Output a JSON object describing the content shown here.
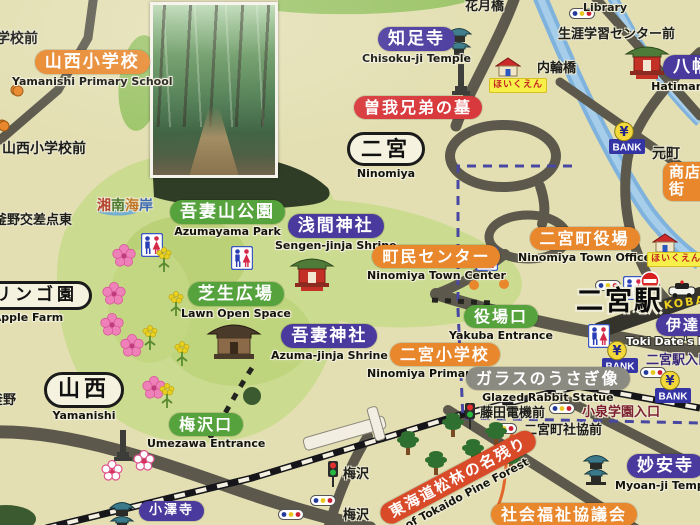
{
  "map": {
    "width": 700,
    "height": 525,
    "kind": "town guide map sign"
  },
  "palette": {
    "background": "#e3dfb2",
    "park_green": "#cbdb90",
    "forest_dark": "#2f3d27",
    "road": "#5c594c",
    "road_dark": "#34332c",
    "river": "#7fb2dc",
    "rail": "#15151a",
    "boundary": "#4848a2",
    "pill_purple": "#4a3a9e",
    "pill_orange": "#e8872c",
    "pill_green": "#56a33d",
    "pill_red": "#d8393c",
    "pill_gray": "#8b8b82",
    "pill_red_diagonal": "#d84a28",
    "bank_blue": "#3434a5",
    "yen_yellow": "#f2d838",
    "hoikuen_yellow": "#f7ef4a",
    "hoikuen_red": "#c42222",
    "koban_yellow": "#f0d020",
    "colorful_chars": [
      "#b5432e",
      "#4a7a2e",
      "#c07828",
      "#3a6ab0"
    ]
  },
  "photo": {
    "name": "forest-path-photo",
    "description": "wooded park trail photo inset"
  },
  "labels": [
    {
      "name": "gakko-mae",
      "type": "plain",
      "jp": "学校前",
      "x": -4,
      "y": 28,
      "fs": 14
    },
    {
      "name": "yamanishi-primary-school",
      "type": "orange-pill",
      "jp": "山西小学校",
      "en": "Yamanishi Primary School",
      "x": 12,
      "y": 50,
      "fs": 17
    },
    {
      "name": "yamanishi-primary-school-mae",
      "type": "plain",
      "jp": "山西小学校前",
      "x": 2,
      "y": 138,
      "fs": 14
    },
    {
      "name": "chisoku-ji-temple",
      "type": "purple-pill",
      "jp": "知足寺",
      "en": "Chisoku-ji Temple",
      "x": 362,
      "y": 27,
      "fs": 17
    },
    {
      "name": "soga-brothers-grave",
      "type": "red-pill",
      "jp": "曽我兄弟の墓",
      "x": 354,
      "y": 96,
      "fs": 16
    },
    {
      "name": "ninomiya-district",
      "type": "white-box",
      "jp": "二宮",
      "en": "Ninomiya",
      "x": 347,
      "y": 132,
      "fs": 21
    },
    {
      "name": "kagetsu-bridge",
      "type": "plain",
      "jp": "花月橋",
      "x": 465,
      "y": -5,
      "fs": 13
    },
    {
      "name": "hoikuen-1",
      "type": "haiku",
      "jp": "ほいくえん",
      "x": 489,
      "y": 78,
      "fs": 9
    },
    {
      "name": "uchiwa-bridge",
      "type": "plain",
      "jp": "内輪橋",
      "x": 537,
      "y": 57,
      "fs": 13
    },
    {
      "name": "library",
      "type": "plain-en",
      "jp": "Library",
      "x": 583,
      "y": 1,
      "fs": 11
    },
    {
      "name": "lifelong-learning-center-mae",
      "type": "plain",
      "jp": "生涯学習センター前",
      "x": 558,
      "y": 23,
      "fs": 13
    },
    {
      "name": "hachimangu",
      "type": "purple-pill",
      "jp": "八幡宮",
      "en": "Hatiman-gu",
      "x": 663,
      "y": 55,
      "fs": 17,
      "en_dx": -14
    },
    {
      "name": "motomachi",
      "type": "plain-outline",
      "jp": "元町",
      "x": 652,
      "y": 143,
      "fs": 14
    },
    {
      "name": "shotengai",
      "type": "orange-pill",
      "jp": "商店街",
      "x": 663,
      "y": 162,
      "fs": 15,
      "w": 36
    },
    {
      "name": "shonan-coast-view",
      "type": "colorful",
      "jp": "湘南海岸",
      "x": 97,
      "y": 195,
      "fs": 14
    },
    {
      "name": "azumayama-park",
      "type": "green-pill",
      "jp": "吾妻山公園",
      "en": "Azumayama Park",
      "x": 170,
      "y": 200,
      "fs": 17
    },
    {
      "name": "sengen-jinja-shrine",
      "type": "purple-pill",
      "jp": "浅間神社",
      "en": "Sengen-jinja Shrine",
      "x": 275,
      "y": 214,
      "fs": 17
    },
    {
      "name": "ninomiya-town-center",
      "type": "orange-pill",
      "jp": "町民センター",
      "en": "Ninomiya Town Center",
      "x": 367,
      "y": 245,
      "fs": 16
    },
    {
      "name": "ninomiya-town-office",
      "type": "orange-pill",
      "jp": "二宮町役場",
      "en": "Ninomiya Town Office",
      "x": 518,
      "y": 227,
      "fs": 16
    },
    {
      "name": "lawn-open-space",
      "type": "green-pill",
      "jp": "芝生広場",
      "en": "Lawn Open Space",
      "x": 181,
      "y": 282,
      "fs": 17
    },
    {
      "name": "apple-farm",
      "type": "white-box",
      "jp": "リンゴ園",
      "en": "Apple Farm",
      "x": -20,
      "y": 281,
      "fs": 17,
      "en_dx": -8
    },
    {
      "name": "yakuba-entrance",
      "type": "green-pill",
      "jp": "役場口",
      "en": "Yakuba Entrance",
      "x": 449,
      "y": 305,
      "fs": 16
    },
    {
      "name": "azuma-jinja-shrine",
      "type": "purple-pill",
      "jp": "吾妻神社",
      "en": "Azuma-jinja Shrine",
      "x": 271,
      "y": 324,
      "fs": 17
    },
    {
      "name": "ninomiya-primary-school",
      "type": "orange-pill",
      "jp": "二宮小学校",
      "en": "Ninomiya Primary School",
      "x": 367,
      "y": 343,
      "fs": 16
    },
    {
      "name": "ninomiya-station",
      "type": "station",
      "jp": "二宮駅",
      "x": 576,
      "y": 288,
      "fs": 27
    },
    {
      "name": "koban",
      "type": "koban",
      "jp": "KOBAN",
      "x": 664,
      "y": 299,
      "fs": 11,
      "rot": -8
    },
    {
      "name": "date-tokei",
      "type": "purple-pill",
      "jp": "伊達時計",
      "x": 656,
      "y": 314,
      "fs": 15
    },
    {
      "name": "toki-date-en",
      "type": "white-outline-text",
      "jp": "Toki Date's Mo",
      "x": 626,
      "y": 335,
      "fs": 11
    },
    {
      "name": "ninomiya-station-entrance",
      "type": "purple-outline-text",
      "jp": "二宮駅入口",
      "x": 646,
      "y": 349,
      "fs": 13
    },
    {
      "name": "glazed-rabbit-statue",
      "type": "gray-pill",
      "jp": "ガラスのうさぎ像",
      "en": "Glazed Rabbit Statue",
      "x": 466,
      "y": 367,
      "fs": 16
    },
    {
      "name": "fujita-denki-mae",
      "type": "plain-outline",
      "jp": "藤田電機前",
      "x": 480,
      "y": 402,
      "fs": 13
    },
    {
      "name": "koizumi-gakuen-entrance",
      "type": "dark-red-text",
      "jp": "小泉学園入口",
      "x": 582,
      "y": 401,
      "fs": 13
    },
    {
      "name": "ninomiya-shakyo-mae",
      "type": "plain-outline",
      "jp": "二宮町社協前",
      "x": 524,
      "y": 419,
      "fs": 13
    },
    {
      "name": "yamanishi-district",
      "type": "white-box",
      "jp": "山西",
      "en": "Yamanishi",
      "x": 44,
      "y": 372,
      "fs": 22
    },
    {
      "name": "umezawa-entrance",
      "type": "green-pill",
      "jp": "梅沢口",
      "en": "Umezawa Entrance",
      "x": 147,
      "y": 413,
      "fs": 16
    },
    {
      "name": "kamano",
      "type": "plain",
      "jp": "釜野",
      "x": -10,
      "y": 389,
      "fs": 13
    },
    {
      "name": "kamano-crossing-east",
      "type": "plain",
      "jp": "釜野交差点東",
      "x": -6,
      "y": 209,
      "fs": 13
    },
    {
      "name": "umezawa-signal",
      "type": "plain",
      "jp": "梅沢",
      "x": 343,
      "y": 463,
      "fs": 13
    },
    {
      "name": "umezawa-busstop",
      "type": "plain",
      "jp": "梅沢",
      "x": 343,
      "y": 504,
      "fs": 13
    },
    {
      "name": "tokaido-pine-forest",
      "type": "red-diagonal",
      "jp": "東海道松林の名残り",
      "en": "of Tokaido Pine Forest",
      "x": 385,
      "y": 506,
      "fs": 15,
      "rot": -28
    },
    {
      "name": "myoan-ji-temple",
      "type": "purple-pill",
      "jp": "妙安寺",
      "en": "Myoan-ji Temple",
      "x": 615,
      "y": 454,
      "fs": 17
    },
    {
      "name": "social-welfare-council",
      "type": "orange-pill",
      "jp": "社会福祉協議会",
      "x": 491,
      "y": 503,
      "fs": 16
    },
    {
      "name": "ozawa-ji-temple",
      "type": "purple-pill",
      "jp": "小澤寺",
      "x": 139,
      "y": 501,
      "fs": 13
    },
    {
      "name": "hoikuen-2",
      "type": "haiku",
      "jp": "ほいくえん",
      "x": 647,
      "y": 252,
      "fs": 9
    }
  ],
  "icons": [
    {
      "type": "restroom",
      "name": "restroom-icon",
      "x": 141,
      "y": 233
    },
    {
      "type": "restroom",
      "name": "restroom-icon",
      "x": 231,
      "y": 246
    },
    {
      "type": "restroom",
      "name": "restroom-icon",
      "x": 476,
      "y": 247
    },
    {
      "type": "restroom",
      "name": "restroom-icon",
      "x": 623,
      "y": 276
    },
    {
      "type": "restroom",
      "name": "restroom-icon",
      "x": 588,
      "y": 324
    },
    {
      "type": "busstop",
      "name": "bus-stop-icon",
      "x": 569,
      "y": 8
    },
    {
      "type": "busstop",
      "name": "bus-stop-icon",
      "x": 595,
      "y": 280
    },
    {
      "type": "busstop",
      "name": "bus-stop-icon",
      "x": 640,
      "y": 367
    },
    {
      "type": "busstop",
      "name": "bus-stop-icon",
      "x": 549,
      "y": 403
    },
    {
      "type": "busstop",
      "name": "bus-stop-icon",
      "x": 491,
      "y": 423
    },
    {
      "type": "busstop",
      "name": "bus-stop-icon",
      "x": 310,
      "y": 495
    },
    {
      "type": "busstop",
      "name": "bus-stop-icon",
      "x": 278,
      "y": 509
    },
    {
      "type": "busdot",
      "name": "bus-stop-dot-icon",
      "x": 12,
      "y": 85
    },
    {
      "type": "busdot",
      "name": "bus-stop-dot-icon",
      "x": -2,
      "y": 120
    },
    {
      "type": "bank",
      "name": "bank-icon",
      "x": 608,
      "y": 122
    },
    {
      "type": "bank",
      "name": "bank-icon",
      "x": 601,
      "y": 341
    },
    {
      "type": "bank",
      "name": "bank-icon",
      "x": 654,
      "y": 371
    },
    {
      "type": "house",
      "name": "nursery-school-icon",
      "x": 495,
      "y": 57
    },
    {
      "type": "house",
      "name": "nursery-school-icon",
      "x": 652,
      "y": 233
    },
    {
      "type": "pagoda",
      "name": "temple-icon",
      "x": 443,
      "y": 22
    },
    {
      "type": "pagoda",
      "name": "temple-icon",
      "x": 580,
      "y": 449
    },
    {
      "type": "pagoda",
      "name": "temple-icon",
      "x": 106,
      "y": 496
    },
    {
      "type": "monument",
      "name": "grave-monument-icon",
      "x": 450,
      "y": 62
    },
    {
      "type": "monument",
      "name": "monument-icon",
      "x": 112,
      "y": 428
    },
    {
      "type": "shrine",
      "name": "shrine-icon",
      "x": 289,
      "y": 252
    },
    {
      "type": "shrine",
      "name": "shrine-icon",
      "x": 624,
      "y": 40
    },
    {
      "type": "bigshrine",
      "name": "shrine-building-icon",
      "x": 206,
      "y": 316
    },
    {
      "type": "policecar",
      "name": "police-car-icon",
      "x": 668,
      "y": 280
    },
    {
      "type": "noentry",
      "name": "no-entry-sign-icon",
      "x": 640,
      "y": 271
    },
    {
      "type": "signal",
      "name": "signal-icon",
      "x": 326,
      "y": 460
    },
    {
      "type": "signal",
      "name": "signal-icon",
      "x": 463,
      "y": 402
    },
    {
      "type": "pine",
      "name": "pine-tree-icon",
      "x": 396,
      "y": 428
    },
    {
      "type": "pine",
      "name": "pine-tree-icon",
      "x": 441,
      "y": 410
    },
    {
      "type": "pine",
      "name": "pine-tree-icon",
      "x": 461,
      "y": 436
    },
    {
      "type": "pine",
      "name": "pine-tree-icon",
      "x": 484,
      "y": 419
    },
    {
      "type": "pine",
      "name": "pine-tree-icon",
      "x": 499,
      "y": 444
    },
    {
      "type": "pine",
      "name": "pine-tree-icon",
      "x": 424,
      "y": 448
    },
    {
      "type": "sakura",
      "name": "cherry-blossom-icon",
      "x": 112,
      "y": 244
    },
    {
      "type": "sakura",
      "name": "cherry-blossom-icon",
      "x": 102,
      "y": 282
    },
    {
      "type": "sakura",
      "name": "cherry-blossom-icon",
      "x": 100,
      "y": 313
    },
    {
      "type": "sakura",
      "name": "cherry-blossom-icon",
      "x": 120,
      "y": 334
    },
    {
      "type": "sakura",
      "name": "cherry-blossom-icon",
      "x": 142,
      "y": 376
    },
    {
      "type": "plum",
      "name": "plum-blossom-icon",
      "x": 101,
      "y": 460
    },
    {
      "type": "plum",
      "name": "plum-blossom-icon",
      "x": 133,
      "y": 450
    },
    {
      "type": "nanohana",
      "name": "rapeseed-flower-icon",
      "x": 154,
      "y": 246
    },
    {
      "type": "nanohana",
      "name": "rapeseed-flower-icon",
      "x": 166,
      "y": 290
    },
    {
      "type": "nanohana",
      "name": "rapeseed-flower-icon",
      "x": 140,
      "y": 324
    },
    {
      "type": "nanohana",
      "name": "rapeseed-flower-icon",
      "x": 172,
      "y": 340
    },
    {
      "type": "nanohana",
      "name": "rapeseed-flower-icon",
      "x": 157,
      "y": 382
    },
    {
      "type": "seablob",
      "name": "sea-view-icon",
      "x": 96,
      "y": 204
    }
  ],
  "bank": {
    "yen": "¥",
    "label": "BANK"
  }
}
